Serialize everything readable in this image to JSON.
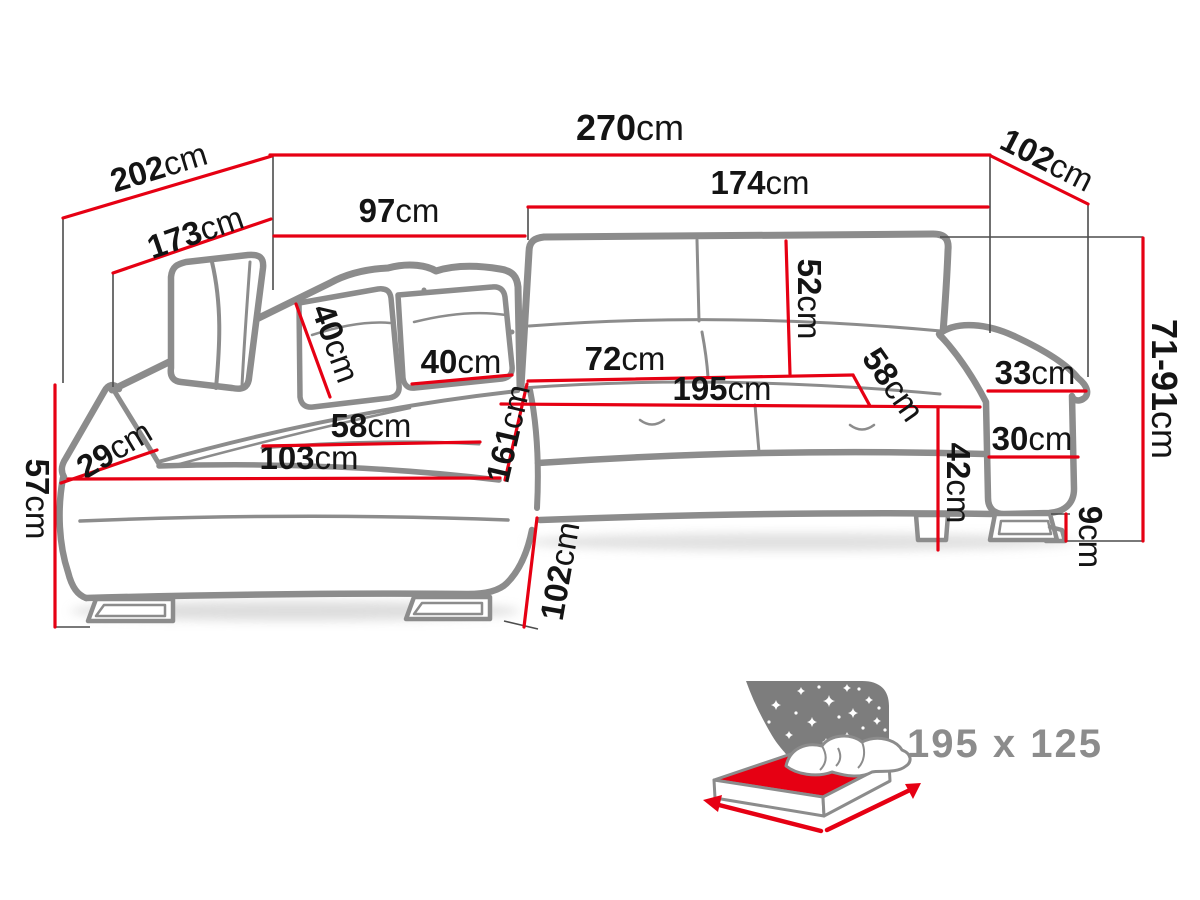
{
  "diagram": {
    "title": "corner-sofa-dimension-diagram",
    "unit": "cm",
    "dims": {
      "d270": {
        "value": "270",
        "unit": "cm"
      },
      "d202": {
        "value": "202",
        "unit": "cm"
      },
      "d173": {
        "value": "173",
        "unit": "cm"
      },
      "d97": {
        "value": "97",
        "unit": "cm"
      },
      "d174": {
        "value": "174",
        "unit": "cm"
      },
      "d102_top": {
        "value": "102",
        "unit": "cm"
      },
      "d71_91": {
        "value": "71-91",
        "unit": "cm"
      },
      "d52": {
        "value": "52",
        "unit": "cm"
      },
      "d40_left_pillow": {
        "value": "40",
        "unit": "cm"
      },
      "d40_right_pillow": {
        "value": "40",
        "unit": "cm"
      },
      "d72": {
        "value": "72",
        "unit": "cm"
      },
      "d195": {
        "value": "195",
        "unit": "cm"
      },
      "d58_right": {
        "value": "58",
        "unit": "cm"
      },
      "d42": {
        "value": "42",
        "unit": "cm"
      },
      "d33": {
        "value": "33",
        "unit": "cm"
      },
      "d30": {
        "value": "30",
        "unit": "cm"
      },
      "d9": {
        "value": "9",
        "unit": "cm"
      },
      "d29": {
        "value": "29",
        "unit": "cm"
      },
      "d57": {
        "value": "57",
        "unit": "cm"
      },
      "d103": {
        "value": "103",
        "unit": "cm"
      },
      "d58_left": {
        "value": "58",
        "unit": "cm"
      },
      "d161": {
        "value": "161",
        "unit": "cm"
      },
      "d102_bottom": {
        "value": "102",
        "unit": "cm"
      }
    },
    "sleeping_area": {
      "size_label": "195 x 125"
    }
  },
  "colors": {
    "dimension_line": "#e60013",
    "sofa_outline": "#8c8c8c",
    "label_text": "#141414",
    "icon_background": "#7d7d7d",
    "page_background": "#ffffff"
  }
}
